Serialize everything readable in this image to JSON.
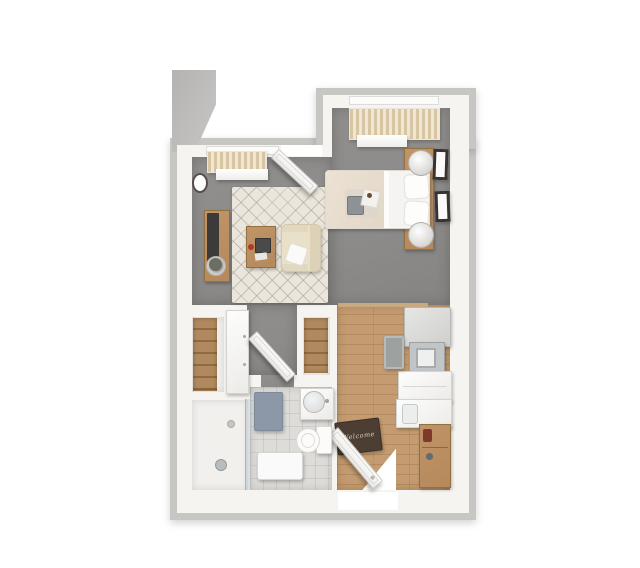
{
  "meta": {
    "title": "3D top-down floor plan rendering of a studio apartment",
    "render_style": "3D architectural dollhouse view on white background"
  },
  "palette": {
    "background": "#ffffff",
    "wall": "#f5f4f1",
    "wall-edge": "#c7c6c3",
    "stub": "#b5b3b1",
    "carpet": "#8c8b89",
    "wood": "#c59c72",
    "wood-seam": "#b58c60",
    "tile": "#dddcd8",
    "rug": "#eae6dd",
    "closet-wood": "#b08a5e",
    "furniture-wood": "#b5895a",
    "sofa": "#e9e0ca",
    "doormat": "#4c3e33",
    "doormat-text": "#d9cfc2",
    "bath-mat": "#8c98a7",
    "tv": "#3c3b39",
    "frame": "#363330",
    "appliance": "#c2c5c6",
    "mug": "#b4372e"
  },
  "rooms": [
    {
      "name": "Living Room",
      "floor": "gray carpet"
    },
    {
      "name": "Bedroom",
      "floor": "gray carpet"
    },
    {
      "name": "Kitchen",
      "floor": "wood plank"
    },
    {
      "name": "Bathroom",
      "floor": "tile with walk-in shower"
    },
    {
      "name": "Closet",
      "floor": "wood shelving"
    },
    {
      "name": "Linen Closet",
      "floor": "wood shelving"
    },
    {
      "name": "Entry",
      "floor": "wood plank"
    }
  ],
  "furniture": {
    "living": [
      "window blinds",
      "open patio door",
      "wall clock",
      "tv console",
      "tv",
      "potted plant",
      "area rug",
      "coffee table",
      "laptop",
      "red mug",
      "loveseat",
      "throw pillow"
    ],
    "bedroom": [
      "window curtains",
      "valance",
      "bed with cream blanket",
      "two pillows",
      "breakfast tray",
      "headboard shelf",
      "two table lamps",
      "two framed artworks"
    ],
    "kitchen": [
      "refrigerator",
      "microwave",
      "base cabinet",
      "counter with sink",
      "kitchen mat",
      "entry console table",
      "welcome mat",
      "open entry door"
    ],
    "bathroom": [
      "vanity with round mirror",
      "toilet",
      "blue bath mat",
      "shower bench",
      "glass shower partition",
      "shower head",
      "floor drain"
    ],
    "closets": [
      "wood shelf unit",
      "white wardrobe cabinet",
      "linen shelf unit",
      "open closet door"
    ]
  },
  "labels": {
    "doormat": "Welcome"
  }
}
